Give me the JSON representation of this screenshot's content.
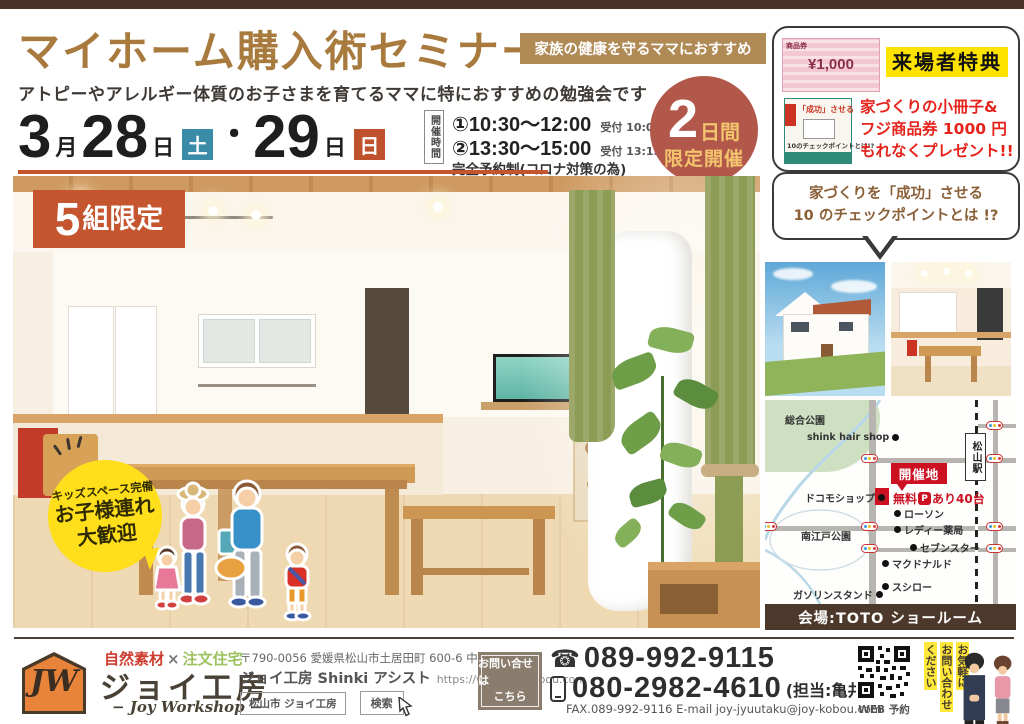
{
  "header": {
    "title": "マイホーム購入術セミナー",
    "badge": "家族の健康を守るママにおすすめ",
    "subtitle": "アトピーやアレルギー体質のお子さまを育てるママに特におすすめの勉強会です"
  },
  "schedule": {
    "month": "3",
    "month_unit": "月",
    "day1": "28",
    "day1_unit": "日",
    "day1_dow": "土",
    "dot": "・",
    "day2": "29",
    "day2_unit": "日",
    "day2_dow": "日",
    "time_header": "開催時間",
    "session1": "①10:30〜12:00",
    "session1_note": "受付 10:00〜",
    "session2": "②13:30〜15:00",
    "session2_note": "受付 13:15〜",
    "reservation_note": "完全予約制(コロナ対策の為)",
    "days_badge": {
      "number": "2",
      "unit": "日間",
      "text": "限定開催"
    }
  },
  "groups_badge": {
    "number": "5",
    "text": "組限定"
  },
  "kids_bubble": {
    "line1": "キッズスペース完備",
    "line2": "お子様連れ",
    "line3": "大歓迎"
  },
  "benefits": {
    "title": "来場者特典",
    "voucher": {
      "label": "商品券",
      "amount": "¥1,000"
    },
    "booklet": {
      "line1": "「成功」させる",
      "line2": "10のチェックポイントとは!?"
    },
    "desc1": "家づくりの小冊子&",
    "desc2": "フジ商品券 1000 円",
    "desc3": "もれなくプレゼント!!",
    "bubble1": "家づくりを「成功」させる",
    "bubble2": "10 のチェックポイントとは !?"
  },
  "map": {
    "park_top": "総合公園",
    "hair_shop": "shink hair shop",
    "station": "松山駅",
    "venue": "開催地",
    "parking_pre": "無料",
    "parking_p": "P",
    "parking_post": "あり40台",
    "docomo": "ドコモショップ",
    "lawson": "ローソン",
    "pharmacy": "レディー薬局",
    "park_south": "南江戸公園",
    "sevenstar": "セブンスター",
    "mcdonalds": "マクドナルド",
    "sushiro": "スシロー",
    "gas_station": "ガソリンスタンド",
    "venue_bar": "会場:TOTO ショールーム"
  },
  "footer": {
    "logo_text": "JW",
    "tag_left": "自然素材",
    "tag_x": "×",
    "tag_right": "注文住宅",
    "company": "ジョイ工房",
    "company_en": "− Joy Workshop −",
    "address": "〒790-0056 愛媛県松山市土居田町 600-6 中島ハイツ 1F",
    "company_sub": "ジョイ工房 Shinki アシスト",
    "url": "https://www.joy-kobou.com",
    "search_query": "松山市 ジョイ工房",
    "search_btn": "検索",
    "contact1": "お問い合せは",
    "contact2": "こちら",
    "tel1": "089-992-9115",
    "tel2": "080-2982-4610",
    "tel2_note": "(担当:亀井)",
    "fax_email": "FAX.089-992-9116  E-mail joy-jyuutaku@joy-kobou.com",
    "qr_label": "WEB 予約",
    "vertical1": "お気軽に",
    "vertical2": "お問い合わせ",
    "vertical3": "ください"
  },
  "colors": {
    "accent_brown": "#a87a3e",
    "badge_tan": "#b08a55",
    "orange_red": "#c4552e",
    "teal_sat": "#3a8ba8",
    "sun_orange": "#c0512d",
    "circle_red": "#b2584a",
    "gold": "#f2c46d",
    "red_text": "#e5231b",
    "highlight_yellow": "#ffe300",
    "bubble_yellow": "#ffdf1b",
    "top_bar_brown": "#4a3228",
    "venue_bar_brown": "#4d392b",
    "logo_orange": "#e8833a",
    "contact_box_brown": "#8b7d6d",
    "map_red": "#cc1122"
  }
}
